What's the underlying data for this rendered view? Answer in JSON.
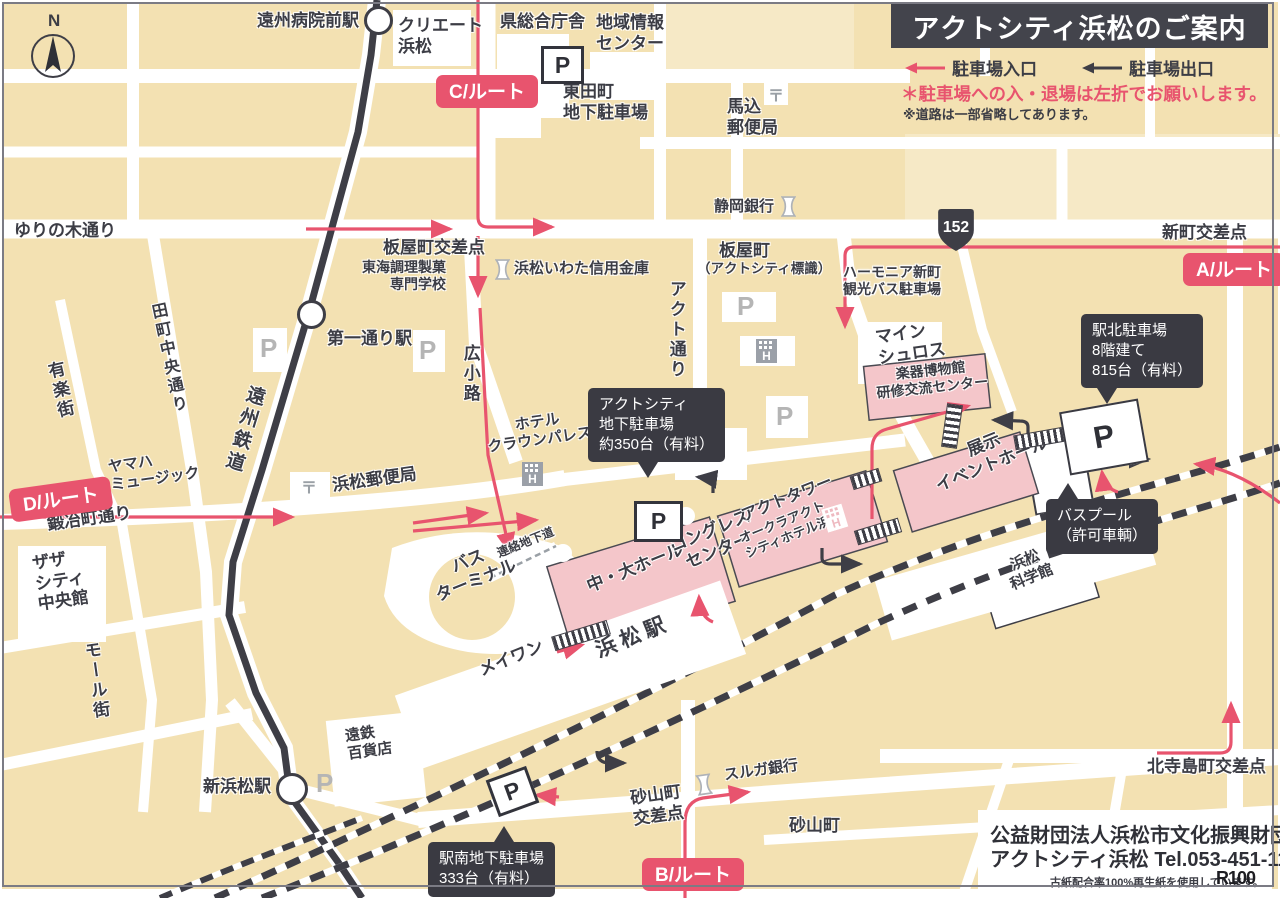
{
  "colors": {
    "cream": "#F3E1B2",
    "road": "#FFFFFF",
    "dark": "#3E3E46",
    "pink": "#E8546E",
    "building_pink": "#F4C6CA"
  },
  "header": {
    "title": "アクトシティ浜松のご案内",
    "legend_entrance": "駐車場入口",
    "legend_exit": "駐車場出口",
    "note_red": "＊駐車場への入・退場は左折でお願いします。",
    "note_gray": "※道路は一部省略してあります。"
  },
  "footer": {
    "org_prefix": "公益",
    "org_rest": "財団法人浜松市文化振興財団",
    "line2": "アクトシティ浜松 Tel.053-451-1111",
    "recycle_note": "古紙配合率100%再生紙を使用しています。",
    "r100": "R100"
  },
  "map": {
    "compass_n": "N",
    "badges": [
      {
        "id": "route-a-badge",
        "label": "A/ルート",
        "x": 1183,
        "y": 253,
        "rot": 0
      },
      {
        "id": "route-b-badge",
        "label": "B/ルート",
        "x": 642,
        "y": 858,
        "rot": 0
      },
      {
        "id": "route-c-badge",
        "label": "C/ルート",
        "x": 436,
        "y": 75,
        "rot": 0
      },
      {
        "id": "route-d-badge",
        "label": "D/ルート",
        "x": 8,
        "y": 490,
        "rot": -8
      }
    ],
    "tooltips": [
      {
        "id": "tooltip-act-parking",
        "lines": [
          "アクトシティ",
          "地下駐車場",
          "約350台（有料）"
        ],
        "x": 588,
        "y": 388,
        "pointer": {
          "side": "bottom",
          "dx": 50
        }
      },
      {
        "id": "tooltip-ekikita-parking",
        "lines": [
          "駅北駐車場",
          "8階建て",
          "815台（有料）"
        ],
        "x": 1081,
        "y": 314,
        "pointer": {
          "side": "bottom",
          "dx": 16
        }
      },
      {
        "id": "tooltip-buspool",
        "lines": [
          "バスプール",
          "（許可車輌）"
        ],
        "x": 1046,
        "y": 499,
        "pointer": {
          "side": "top",
          "dx": 12
        }
      },
      {
        "id": "tooltip-ekiminami-parking",
        "lines": [
          "駅南地下駐車場",
          "333台（有料）"
        ],
        "x": 428,
        "y": 842,
        "pointer": {
          "side": "top",
          "dx": 66
        }
      }
    ],
    "labels": [
      {
        "id": "label-enshu-byoinmae-station",
        "x": 257,
        "y": 11,
        "size": 17,
        "lines": [
          "遠州病院前駅"
        ]
      },
      {
        "id": "label-create-hamamatsu",
        "x": 398,
        "y": 16,
        "size": 17,
        "lines": [
          "クリエート",
          "浜松"
        ]
      },
      {
        "id": "label-ken-sogo-chosha",
        "x": 500,
        "y": 12,
        "size": 17,
        "lines": [
          "県総合庁舎"
        ]
      },
      {
        "id": "label-chiiki-joho-center",
        "x": 596,
        "y": 13,
        "size": 17,
        "lines": [
          "地域情報",
          "センター"
        ]
      },
      {
        "id": "label-higashidacho-parking",
        "x": 563,
        "y": 82,
        "size": 17,
        "lines": [
          "東田町",
          "地下駐車場"
        ]
      },
      {
        "id": "label-magome-post-office",
        "x": 727,
        "y": 97,
        "size": 17,
        "lines": [
          "馬込",
          "郵便局"
        ]
      },
      {
        "id": "label-yurinoki-dori",
        "x": 14,
        "y": 221,
        "size": 17,
        "lines": [
          "ゆりの木通り"
        ]
      },
      {
        "id": "label-itayacho-kosaten",
        "x": 383,
        "y": 238,
        "size": 17,
        "lines": [
          "板屋町交差点"
        ]
      },
      {
        "id": "label-tokai-chori-semmon",
        "x": 362,
        "y": 259,
        "size": 14,
        "align": "right",
        "lines": [
          "東海調理製菓",
          "専門学校"
        ]
      },
      {
        "id": "label-hamamatsu-iwata-shinkin",
        "x": 514,
        "y": 260,
        "size": 15,
        "lines": [
          "浜松いわた信用金庫"
        ]
      },
      {
        "id": "label-shizuoka-bank",
        "x": 714,
        "y": 198,
        "size": 15,
        "lines": [
          "静岡銀行"
        ]
      },
      {
        "id": "label-itayacho",
        "x": 719,
        "y": 241,
        "size": 17,
        "lines": [
          "板屋町"
        ]
      },
      {
        "id": "label-act-city-hyoshiki",
        "x": 697,
        "y": 261,
        "size": 13.5,
        "lines": [
          "（アクトシティ標識）"
        ]
      },
      {
        "id": "label-harmonia-shinmachi",
        "x": 843,
        "y": 264,
        "size": 14,
        "halo": true,
        "lines": [
          "ハーモニア新町",
          "観光バス駐車場"
        ]
      },
      {
        "id": "label-shinmachi-kosaten",
        "x": 1162,
        "y": 223,
        "size": 17,
        "lines": [
          "新町交差点"
        ]
      },
      {
        "id": "label-mein-schloss",
        "x": 874,
        "y": 328,
        "size": 17,
        "rot": -8,
        "lines": [
          "マイン",
          "シュロス"
        ]
      },
      {
        "id": "label-daiichidori-station",
        "x": 327,
        "y": 329,
        "size": 17,
        "lines": [
          "第一通り駅"
        ]
      },
      {
        "id": "label-tamachi-chuo-dori",
        "x": 146,
        "y": 305,
        "size": 16,
        "rot": -12,
        "v": true,
        "lines": [
          "田町中央通り"
        ]
      },
      {
        "id": "label-yuraku-gai",
        "x": 42,
        "y": 364,
        "size": 17,
        "rot": -13,
        "v": true,
        "lines": [
          "有楽街"
        ]
      },
      {
        "id": "label-enshu-tetsudo",
        "x": 246,
        "y": 382,
        "size": 19,
        "rot": 17,
        "v": true,
        "spacing": 4,
        "lines": [
          "遠州鉄道"
        ]
      },
      {
        "id": "label-hirokoji",
        "x": 459,
        "y": 344,
        "size": 17,
        "v": true,
        "lines": [
          "広小路"
        ]
      },
      {
        "id": "label-act-dori",
        "x": 665,
        "y": 280,
        "size": 17,
        "v": true,
        "lines": [
          "アクト通り"
        ]
      },
      {
        "id": "label-yamaha-music",
        "x": 107,
        "y": 459,
        "size": 15,
        "rot": -8,
        "lines": [
          "ヤマハ",
          "ミュージック"
        ]
      },
      {
        "id": "label-kajimachi-dori",
        "x": 46,
        "y": 515,
        "size": 17,
        "rot": -8,
        "lines": [
          "鍛冶町通り"
        ]
      },
      {
        "id": "label-zaza-city",
        "x": 31,
        "y": 554,
        "size": 17,
        "rot": -8,
        "lines": [
          "ザザ",
          "シティ",
          "中央館"
        ]
      },
      {
        "id": "label-mall-gai",
        "x": 79,
        "y": 643,
        "size": 17,
        "rot": -8,
        "v": true,
        "lines": [
          "モール街"
        ]
      },
      {
        "id": "label-hotel-crown-palace",
        "x": 484,
        "y": 421,
        "size": 15,
        "rot": -8,
        "align": "center",
        "lines": [
          "ホテル",
          "クラウンパレス"
        ]
      },
      {
        "id": "label-hamamatsu-post-office",
        "x": 331,
        "y": 476,
        "size": 17,
        "rot": -8,
        "lines": [
          "浜松郵便局"
        ]
      },
      {
        "id": "label-bus-terminal",
        "x": 425,
        "y": 568,
        "size": 17,
        "rot": -22,
        "align": "center",
        "lines": [
          "バス",
          "ターミナル"
        ]
      },
      {
        "id": "label-renraku-chikado",
        "x": 495,
        "y": 547,
        "size": 12,
        "rot": -22,
        "halo": true,
        "lines": [
          "連絡地下道"
        ]
      },
      {
        "id": "label-chu-dai-hall",
        "x": 584,
        "y": 578,
        "size": 17,
        "rot": -22,
        "lines": [
          "中・大ホール"
        ]
      },
      {
        "id": "label-congress-center",
        "x": 667,
        "y": 538,
        "size": 17,
        "rot": -22,
        "align": "center",
        "lines": [
          "コングレス",
          "センター"
        ]
      },
      {
        "id": "label-act-tower",
        "x": 739,
        "y": 508,
        "size": 16,
        "rot": -22,
        "lines": [
          "アクトタワー"
        ]
      },
      {
        "id": "label-okura-act-city-hotel",
        "x": 737,
        "y": 532,
        "size": 13,
        "rot": -22,
        "lines": [
          "オークラアクト",
          "シティホテル浜松"
        ]
      },
      {
        "id": "label-gakki-museum",
        "x": 874,
        "y": 368,
        "size": 14,
        "rot": -6,
        "align": "center",
        "lines": [
          "楽器博物館",
          "研修交流センター"
        ]
      },
      {
        "id": "label-tenji-event-hall",
        "x": 925,
        "y": 458,
        "size": 17,
        "rot": -22,
        "align": "center",
        "lines": [
          "展示",
          "イベントホール"
        ]
      },
      {
        "id": "label-hamamatsu-science",
        "x": 1001,
        "y": 561,
        "size": 15,
        "rot": -22,
        "align": "center",
        "lines": [
          "浜松",
          "科学館"
        ]
      },
      {
        "id": "label-hamamatsu-station",
        "x": 592,
        "y": 640,
        "size": 21,
        "rot": -22,
        "spacing": 5,
        "lines": [
          "浜松駅"
        ]
      },
      {
        "id": "label-meiwan",
        "x": 476,
        "y": 662,
        "size": 17,
        "rot": -22,
        "lines": [
          "メイワン"
        ]
      },
      {
        "id": "label-shin-hamamatsu-station",
        "x": 203,
        "y": 777,
        "size": 17,
        "lines": [
          "新浜松駅"
        ]
      },
      {
        "id": "label-entetsu-dept",
        "x": 344,
        "y": 728,
        "size": 15,
        "rot": -8,
        "lines": [
          "遠鉄",
          "百貨店"
        ]
      },
      {
        "id": "label-sunayama-kosaten",
        "x": 629,
        "y": 789,
        "size": 17,
        "rot": -8,
        "align": "center",
        "lines": [
          "砂山町",
          "交差点"
        ]
      },
      {
        "id": "label-suruga-bank",
        "x": 723,
        "y": 767,
        "size": 15,
        "rot": -8,
        "lines": [
          "スルガ銀行"
        ]
      },
      {
        "id": "label-sunayamacho",
        "x": 789,
        "y": 816,
        "size": 17,
        "lines": [
          "砂山町"
        ]
      },
      {
        "id": "label-kita-terajima-kosaten",
        "x": 1147,
        "y": 757,
        "size": 17,
        "lines": [
          "北寺島町交差点"
        ]
      }
    ],
    "icons": [
      {
        "id": "bridge-1",
        "type": "bridge",
        "x": 552,
        "y": 628,
        "w": 56,
        "h": 13,
        "rot": -17
      },
      {
        "id": "bridge-2",
        "type": "bridge",
        "x": 855,
        "y": 524,
        "w": 44,
        "h": 13,
        "rot": -17
      },
      {
        "id": "bridge-3",
        "type": "bridge",
        "x": 851,
        "y": 472,
        "w": 28,
        "h": 12,
        "rot": -17
      },
      {
        "id": "bridge-4",
        "type": "bridge",
        "x": 944,
        "y": 404,
        "w": 14,
        "h": 42,
        "rot": 8,
        "vstripe": true
      },
      {
        "id": "bridge-5",
        "type": "bridge",
        "x": 1014,
        "y": 430,
        "w": 60,
        "h": 13,
        "rot": -10
      },
      {
        "id": "icon-parking-higashida",
        "type": "p-framed",
        "x": 541,
        "y": 46,
        "w": 37,
        "h": 32,
        "glyph": "P"
      },
      {
        "id": "icon-parking-act",
        "type": "p-framed",
        "x": 634,
        "y": 501,
        "w": 43,
        "h": 35,
        "glyph": "P"
      },
      {
        "id": "icon-parking-ekiminami",
        "type": "p-framed",
        "x": 491,
        "y": 772,
        "w": 37,
        "h": 33,
        "rot": -20,
        "glyph": "P"
      },
      {
        "id": "icon-parking-ekikita-building",
        "type": "p-building",
        "x": 1064,
        "y": 405,
        "w": 76,
        "h": 60,
        "rot": -10,
        "glyph": "P"
      },
      {
        "id": "icon-parking-gray-1",
        "type": "p-gray",
        "x": 260,
        "y": 335,
        "glyph": "P"
      },
      {
        "id": "icon-parking-gray-2",
        "type": "p-gray",
        "x": 419,
        "y": 337,
        "glyph": "P"
      },
      {
        "id": "icon-parking-gray-3",
        "type": "p-gray",
        "x": 737,
        "y": 293,
        "glyph": "P"
      },
      {
        "id": "icon-parking-gray-4",
        "type": "p-gray",
        "x": 776,
        "y": 403,
        "glyph": "P"
      },
      {
        "id": "icon-parking-gray-5",
        "type": "p-gray",
        "x": 316,
        "y": 770,
        "glyph": "P"
      },
      {
        "id": "icon-post-magome",
        "type": "post",
        "x": 764,
        "y": 83,
        "glyph": "〒"
      },
      {
        "id": "icon-post-hamamatsu",
        "type": "post",
        "x": 297,
        "y": 475,
        "glyph": "〒"
      },
      {
        "id": "icon-bank-iwata-shinkin",
        "type": "bank",
        "x": 495,
        "y": 259
      },
      {
        "id": "icon-bank-shizuoka",
        "type": "bank",
        "x": 781,
        "y": 196
      },
      {
        "id": "icon-bank-suruga",
        "type": "bank",
        "x": 697,
        "y": 774,
        "rot": -8
      },
      {
        "id": "icon-hotel-crown-palace",
        "type": "hotel",
        "x": 520,
        "y": 462,
        "variant": "gray"
      },
      {
        "id": "icon-hotel-generic",
        "type": "hotel",
        "x": 754,
        "y": 339,
        "variant": "gray"
      },
      {
        "id": "icon-hotel-okura",
        "type": "hotel",
        "x": 823,
        "y": 506,
        "variant": "white",
        "rot": -17
      },
      {
        "id": "icon-station-enshu-byo inmae",
        "type": "station-circle",
        "x": 364,
        "y": 6,
        "d": 23
      },
      {
        "id": "icon-station-daiichidori",
        "type": "station-circle",
        "x": 297,
        "y": 300,
        "d": 23
      },
      {
        "id": "icon-station-shin-hamamatsu",
        "type": "station-circle",
        "x": 276,
        "y": 773,
        "d": 26
      },
      {
        "id": "icon-route-shield-152",
        "type": "shield",
        "x": 937,
        "y": 209,
        "w": 38,
        "h": 42,
        "glyph": "152"
      }
    ]
  }
}
